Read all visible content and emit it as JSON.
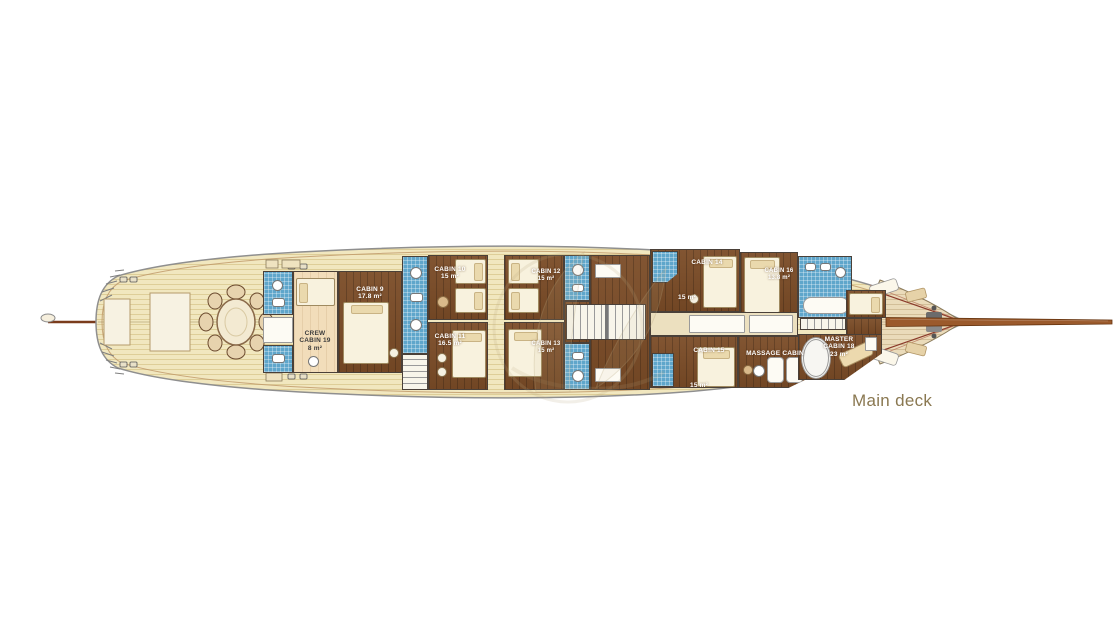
{
  "deck_label": {
    "text": "Main deck"
  },
  "rooms": [
    {
      "id": "crew-cabin-19",
      "name": "CREW\nCABIN 19",
      "area": "8 m²"
    },
    {
      "id": "cabin-9",
      "name": "CABIN 9",
      "area": "17.8 m²"
    },
    {
      "id": "cabin-10",
      "name": "CABIN 10",
      "area": "15 m²"
    },
    {
      "id": "cabin-11",
      "name": "CABIN 11",
      "area": "16.5 m²"
    },
    {
      "id": "cabin-12",
      "name": "CABIN 12",
      "area": "15 m²"
    },
    {
      "id": "cabin-13",
      "name": "CABIN 13",
      "area": "15 m²"
    },
    {
      "id": "cabin-14",
      "name": "CABIN 14",
      "area": "15 m²"
    },
    {
      "id": "cabin-15",
      "name": "CABIN 15",
      "area": "15 m²"
    },
    {
      "id": "cabin-16",
      "name": "CABIN 16",
      "area": "13.8 m²"
    },
    {
      "id": "massage-cabin",
      "name": "MASSAGE CABIN",
      "area": ""
    },
    {
      "id": "master-cabin-18",
      "name": "MASTER\nCABIN 18",
      "area": "23 m²"
    }
  ],
  "palette": {
    "deck_plank": "#f1e7bf",
    "foredeck_plank": "#eadbba",
    "cabin_wood": "#7b4c27",
    "bathroom_tile": "#5fa6cb",
    "bed_linen": "#f8f2de",
    "hull_outline": "#8f8f8f",
    "bowsprit": "#9b5a2c",
    "room_label_text": "#ffffff",
    "deck_label_text": "#8a7851"
  }
}
